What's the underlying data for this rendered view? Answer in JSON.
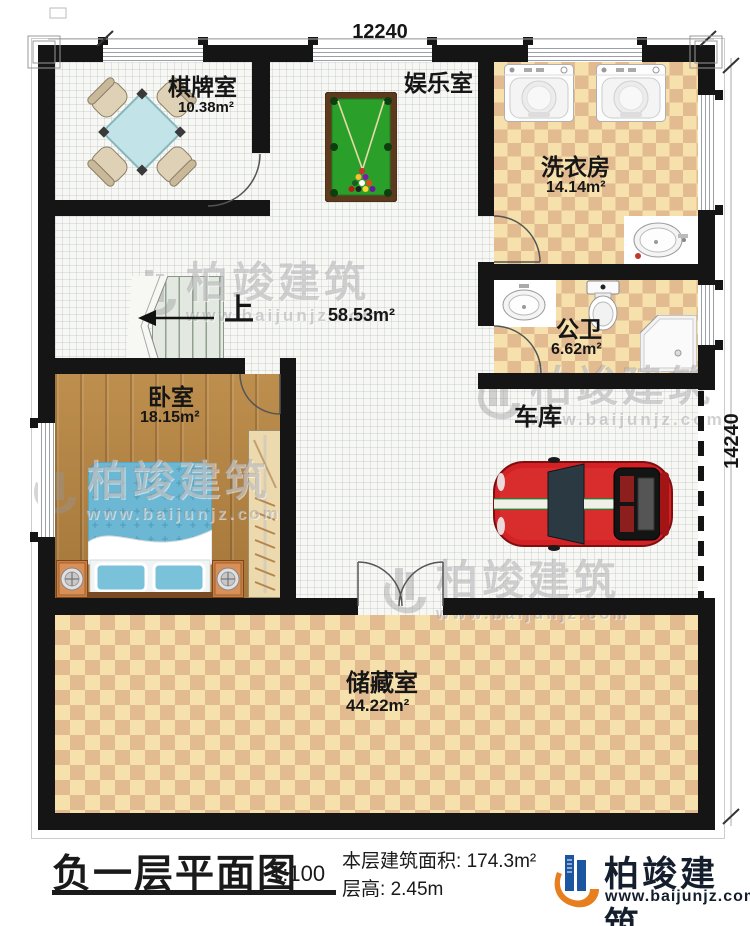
{
  "title_block": {
    "title": "负一层平面图",
    "scale": "1:100",
    "area_label": "本层建筑面积:",
    "area_value": "174.3m²",
    "floor_height_label": "层高:",
    "floor_height_value": "2.45m"
  },
  "dimensions": {
    "width": "12240",
    "height": "14240"
  },
  "rooms": {
    "chess": {
      "name": "棋牌室",
      "area": "10.38m²"
    },
    "entertainment": {
      "name": "娱乐室"
    },
    "laundry": {
      "name": "洗衣房",
      "area": "14.14m²"
    },
    "bathroom": {
      "name": "公卫",
      "area": "6.62m²"
    },
    "hall": {
      "area": "58.53m²"
    },
    "garage": {
      "name": "车库"
    },
    "bedroom": {
      "name": "卧室",
      "area": "18.15m²"
    },
    "storage": {
      "name": "储藏室",
      "area": "44.22m²"
    }
  },
  "stairs": {
    "up_label": "上"
  },
  "branding": {
    "company": "柏竣建筑",
    "website": "www.baijunjz.com"
  },
  "watermark": {
    "company": "柏竣建筑",
    "website": "www.baijunjz.com"
  },
  "colors": {
    "wall": "#151515",
    "checker_light": "#f6e1ac",
    "checker_dark": "#e2bb90",
    "wood": "#b2813f",
    "car_red": "#d32125",
    "felt_green": "#2aa02a",
    "logo_blue": "#1c56a0",
    "logo_orange": "#e87f1e"
  }
}
